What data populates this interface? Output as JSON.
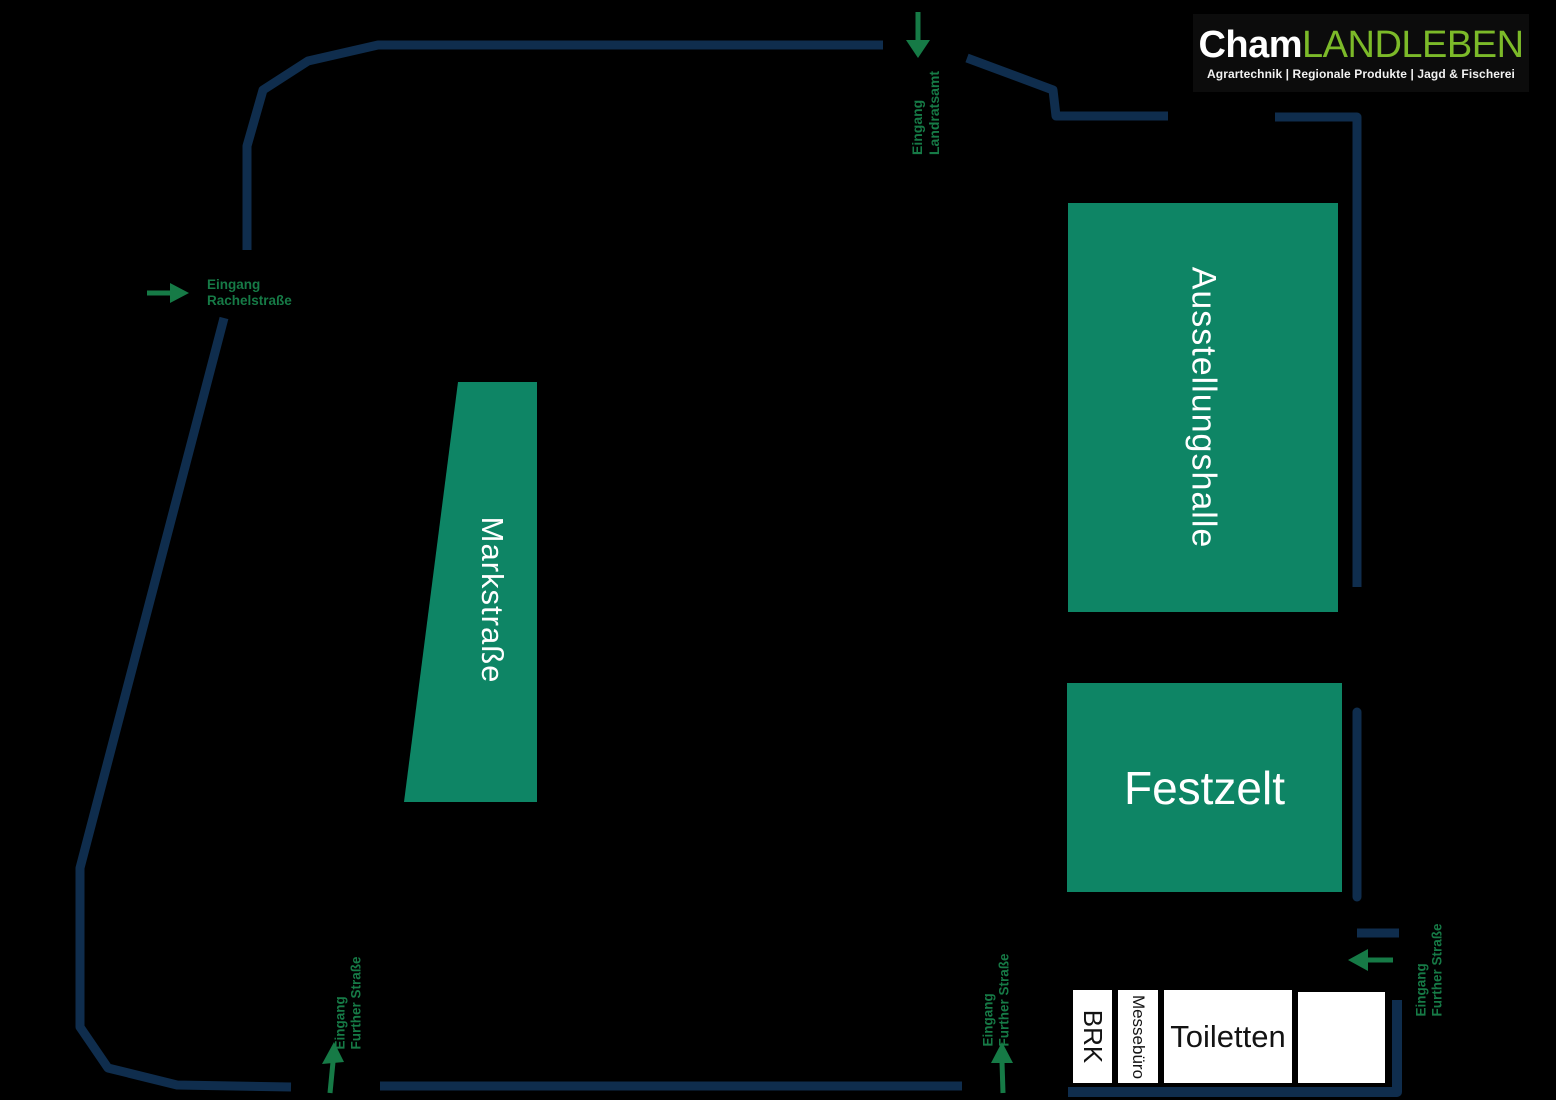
{
  "logo": {
    "brand_left": "Cham",
    "brand_right": "LANDLEBEN",
    "tagline": "Agrartechnik | Regionale Produkte | Jagd & Fischerei"
  },
  "buildings": {
    "markstrasse": {
      "label": "Markstraße"
    },
    "ausstellungshalle": {
      "label": "Ausstellungshalle"
    },
    "festzelt": {
      "label": "Festzelt"
    }
  },
  "facilities": {
    "brk": {
      "label": "BRK"
    },
    "messebuero": {
      "label": "Messebüro"
    },
    "toiletten": {
      "label": "Toiletten"
    },
    "unlabeled": {
      "label": ""
    }
  },
  "entrances": [
    {
      "id": "landratsamt",
      "label": "Eingang\nLandratsamt",
      "icon": "arrow-down-icon"
    },
    {
      "id": "rachelstrasse",
      "label": "Eingang\nRachelstraße",
      "icon": "arrow-right-icon"
    },
    {
      "id": "further-strasse-west",
      "label": "Eingang\nFurther Straße",
      "icon": "arrow-up-icon"
    },
    {
      "id": "further-strasse-mitte",
      "label": "Eingang\nFurther Straße",
      "icon": "arrow-up-icon"
    },
    {
      "id": "further-strasse-ost",
      "label": "Eingang\nFurther Straße",
      "icon": "arrow-left-icon"
    }
  ],
  "colors": {
    "background": "#000000",
    "building_green": "#0E8565",
    "entrance_green": "#167A46",
    "boundary_navy": "#0F2D4D",
    "logo_green": "#7CBA29",
    "facility_white": "#FFFFFF"
  }
}
